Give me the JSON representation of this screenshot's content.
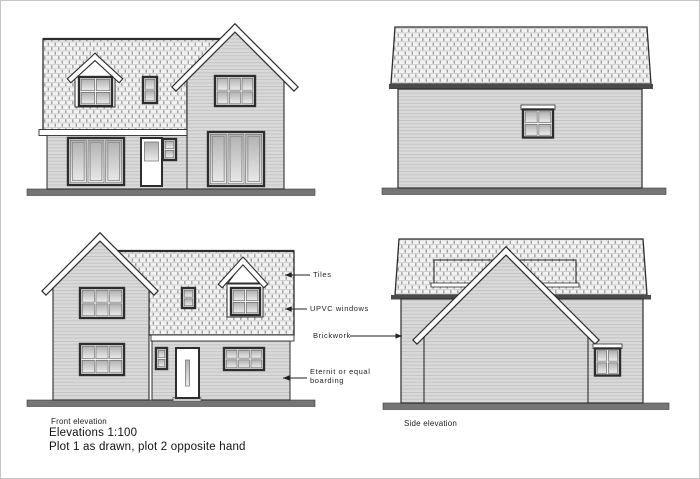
{
  "drawing": {
    "captions": {
      "front_elevation": "Front elevation",
      "side_elevation": "Side elevation",
      "scale_note": "Elevations 1:100",
      "plot_note": "Plot 1 as drawn, plot 2 opposite hand"
    },
    "annotations": {
      "tiles": "Tiles",
      "upvc": "UPVC windows",
      "brickwork": "Brickwork",
      "eternit_line1": "Eternit or equal",
      "eternit_line2": "boarding"
    },
    "colors": {
      "outline": "#2d2d2d",
      "wall": "#d9d9d9",
      "roof": "#f2f2f2",
      "ground": "#757575",
      "fascia": "#ffffff"
    }
  }
}
